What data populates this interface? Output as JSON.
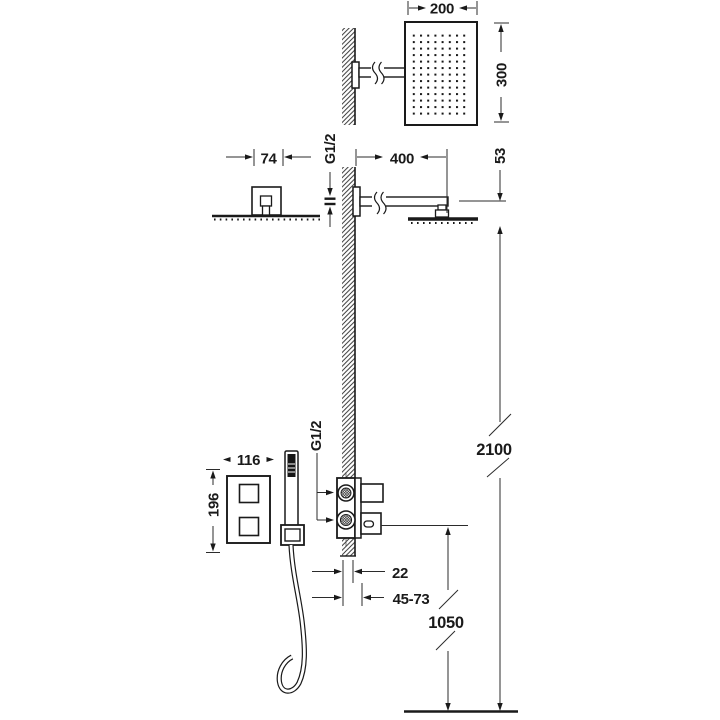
{
  "page": {
    "background": "#ffffff",
    "line_color": "#1a1a1a",
    "description": "Technical installation drawing of a wall-mounted shower system with thermostatic mixer and hand shower"
  },
  "labels": {
    "head_width": "200",
    "head_height": "300",
    "rosette_width": "74",
    "top_thread": "G1/2",
    "arm_length": "400",
    "head_offset": "53",
    "overhead_height": "2100",
    "plate_width": "116",
    "plate_height": "196",
    "valve_thread": "G1/2",
    "wall_depth_min": "22",
    "wall_depth_range": "45-73",
    "valve_height": "1050"
  }
}
